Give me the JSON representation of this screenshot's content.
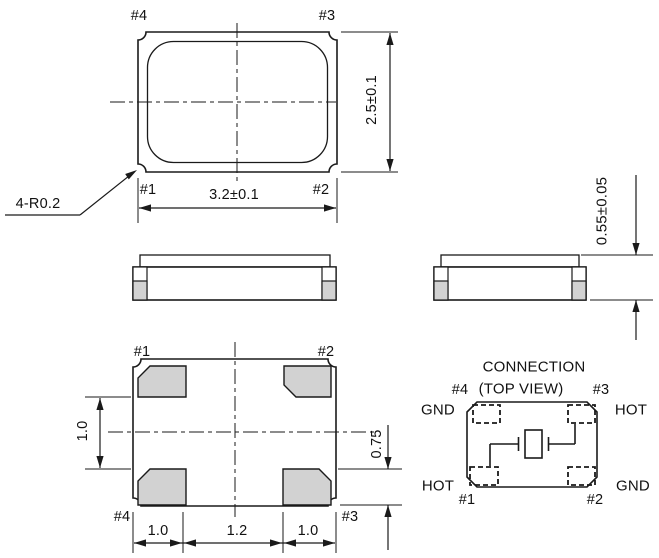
{
  "colors": {
    "line": "#1a1a1a",
    "pad_fill": "#d2d2d2",
    "background": "#ffffff"
  },
  "top_view": {
    "pin_top_left": "#4",
    "pin_top_right": "#3",
    "pin_bottom_left": "#1",
    "pin_bottom_right": "#2",
    "width_dim": "3.2±0.1",
    "height_dim": "2.5±0.1",
    "corner_radius_note": "4-R0.2"
  },
  "side_view": {
    "height_dim": "0.55±0.05"
  },
  "bottom_view": {
    "pin_top_left": "#1",
    "pin_top_right": "#2",
    "pin_bottom_left": "#4",
    "pin_bottom_right": "#3",
    "pad_gap_dim": "1.0",
    "pad_height_dim": "0.75",
    "bottom_dims": [
      "1.0",
      "1.2",
      "1.0"
    ]
  },
  "connection": {
    "title": "CONNECTION",
    "subtitle": "(TOP VIEW)",
    "pin_top_left": {
      "num": "#4",
      "signal": "GND"
    },
    "pin_top_right": {
      "num": "#3",
      "signal": "HOT"
    },
    "pin_bottom_left": {
      "num": "#1",
      "signal": "HOT"
    },
    "pin_bottom_right": {
      "num": "#2",
      "signal": "GND"
    }
  }
}
